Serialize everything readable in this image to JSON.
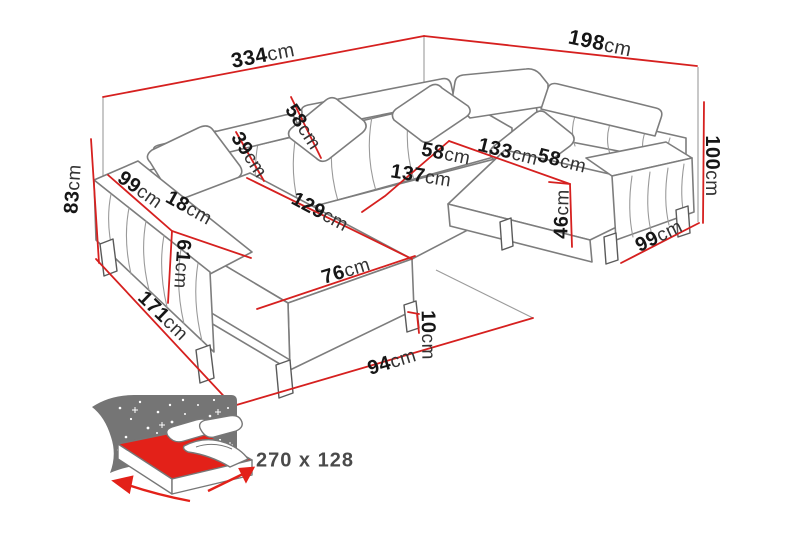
{
  "diagram": {
    "type": "corner-sofa-dimension-diagram",
    "unit_suffix": "cm",
    "colors": {
      "dimension_red": "#d6201f",
      "sofa_line_gray": "#7d7d7d",
      "bed_mattress_red": "#e32119",
      "starry_backdrop_gray": "#757575"
    },
    "dimensions": {
      "overall_width": {
        "value": "334",
        "unit": "cm"
      },
      "overall_depth_right": {
        "value": "198",
        "unit": "cm"
      },
      "back_height": {
        "value": "83",
        "unit": "cm"
      },
      "armrest_length_left": {
        "value": "99",
        "unit": "cm"
      },
      "armrest_width": {
        "value": "18",
        "unit": "cm"
      },
      "armrest_front_height": {
        "value": "61",
        "unit": "cm"
      },
      "backrest_height": {
        "value": "39",
        "unit": "cm"
      },
      "headrest_diagonal": {
        "value": "58",
        "unit": "cm"
      },
      "chaise_length": {
        "value": "129",
        "unit": "cm"
      },
      "chaise_width": {
        "value": "76",
        "unit": "cm"
      },
      "seat_depth_left": {
        "value": "58",
        "unit": "cm"
      },
      "seat_length_middle": {
        "value": "137",
        "unit": "cm"
      },
      "corner_width": {
        "value": "133",
        "unit": "cm"
      },
      "seat_depth_right": {
        "value": "58",
        "unit": "cm"
      },
      "seat_height": {
        "value": "46",
        "unit": "cm"
      },
      "total_height_right": {
        "value": "100",
        "unit": "cm"
      },
      "armrest_length_right": {
        "value": "99",
        "unit": "cm"
      },
      "leg_height": {
        "value": "10",
        "unit": "cm"
      },
      "side_depth_left": {
        "value": "171",
        "unit": "cm"
      },
      "front_width": {
        "value": "94",
        "unit": "cm"
      }
    },
    "sleeping_area": {
      "label": "270 x 128"
    }
  }
}
